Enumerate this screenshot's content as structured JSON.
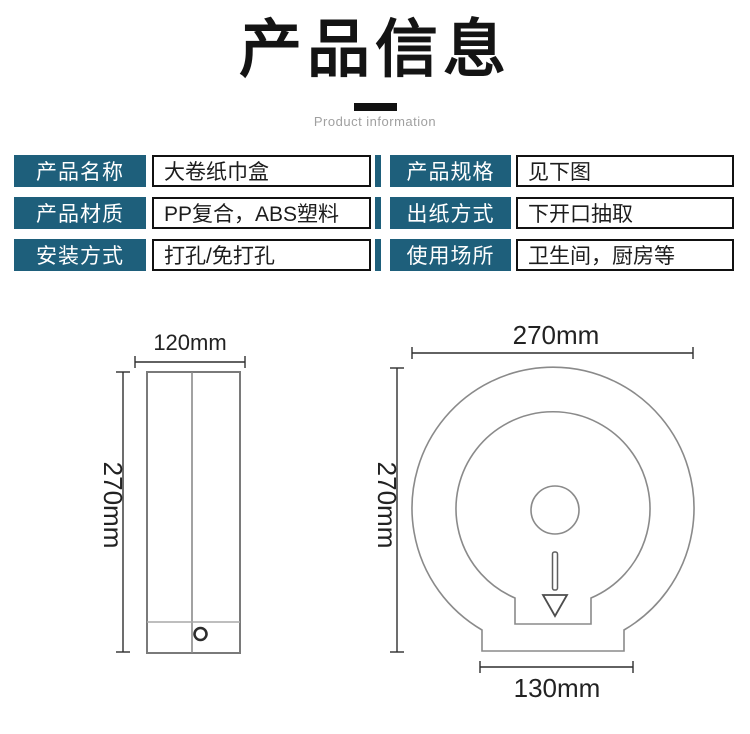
{
  "header": {
    "title": "产品信息",
    "subtitle": "Product information"
  },
  "colors": {
    "accent_teal": "#1e5f7b",
    "value_border": "#111111",
    "diagram_line_gray": "#8a8a8a",
    "dimension_line": "#2f2f2f",
    "title_black": "#141414",
    "subtitle_gray": "#a0a0a0"
  },
  "spec_table": {
    "left_rows": [
      {
        "label": "产品名称",
        "value": "大卷纸巾盒"
      },
      {
        "label": "产品材质",
        "value": "PP复合，ABS塑料"
      },
      {
        "label": "安装方式",
        "value": "打孔/免打孔"
      }
    ],
    "right_rows": [
      {
        "label": "产品规格",
        "value": "见下图"
      },
      {
        "label": "出纸方式",
        "value": "下开口抽取"
      },
      {
        "label": "使用场所",
        "value": "卫生间，厨房等"
      }
    ]
  },
  "diagrams": {
    "side_view": {
      "width_label": "120mm",
      "height_label": "270mm"
    },
    "front_view": {
      "width_label": "270mm",
      "height_label": "270mm",
      "base_label": "130mm"
    }
  }
}
